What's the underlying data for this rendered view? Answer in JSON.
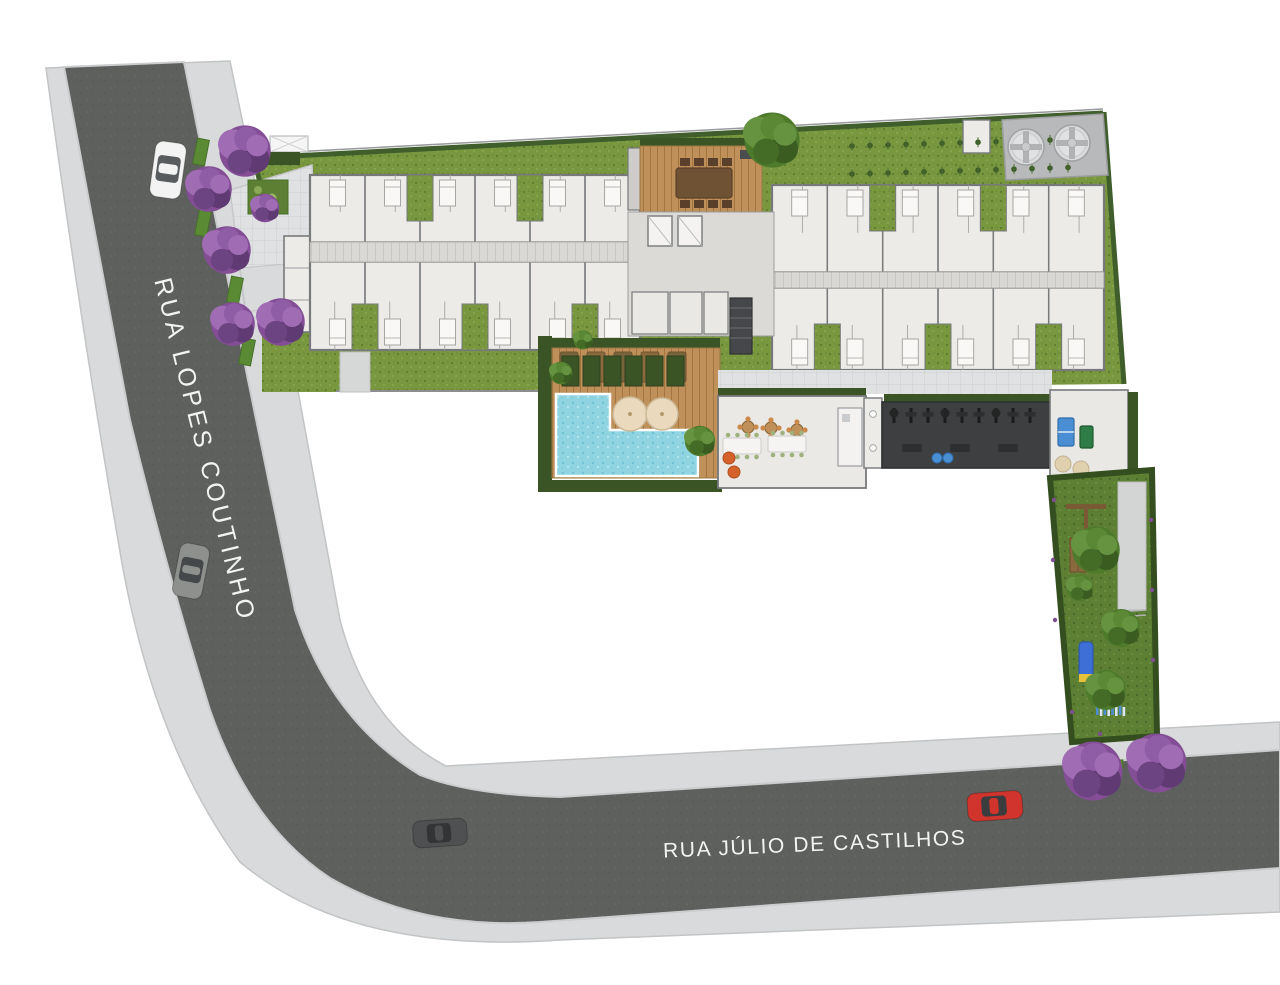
{
  "streets": {
    "diagonal": "RUA LOPES COUTINHO",
    "horizontal": "RUA JÚLIO DE CASTILHOS"
  },
  "palette": {
    "sidewalk": "#d8dadb",
    "curb": "#c9cbcc",
    "asphalt": "#5d605d",
    "wall": "#77797b",
    "wallLight": "#a8a6a3",
    "room": "#ecebe8",
    "bed": "#f9f8f6",
    "corridor": "#dad8d4",
    "grass": "#79973f",
    "grassDark": "#5d7f33",
    "hedge": "#3a5426",
    "hedgeDark": "#2c401f",
    "wood": "#bf9059",
    "woodDark": "#8a6a3c",
    "pool": "#8fd4e0",
    "gymFloor": "#3d3f40",
    "pad": "#b7b9ba",
    "tank": "#d8dadb",
    "umbrella": "#ead9bc",
    "pouf": "#d4622a",
    "blue": "#4a8fd4",
    "purpleTree": [
      "#834e95",
      "#a06cb4",
      "#5f3a73",
      "#8f5da5",
      "#6d4482"
    ],
    "greenTree": [
      "#4e7a2c",
      "#659340",
      "#3a5c20",
      "#5a8835",
      "#456c26"
    ]
  },
  "scene": {
    "cars": [
      {
        "name": "white-car",
        "x": 168,
        "y": 170,
        "w": 31,
        "l": 56,
        "rot": 8,
        "body": "#f2f3f2",
        "cabin": "#585c5f",
        "vertical": true
      },
      {
        "name": "gray-car",
        "x": 191,
        "y": 571,
        "w": 30,
        "l": 54,
        "rot": 11,
        "body": "#8d908d",
        "cabin": "#45484b",
        "vertical": true
      },
      {
        "name": "dark-car",
        "x": 440,
        "y": 833,
        "w": 27,
        "l": 54,
        "rot": -4,
        "body": "#4e5051",
        "cabin": "#323435",
        "vertical": false
      },
      {
        "name": "red-car",
        "x": 995,
        "y": 806,
        "w": 28,
        "l": 55,
        "rot": -4,
        "body": "#d0342c",
        "cabin": "#3a3c3e",
        "vertical": false
      }
    ],
    "purple_trees": [
      [
        245,
        151,
        27
      ],
      [
        209,
        189,
        24
      ],
      [
        227,
        250,
        25
      ],
      [
        233,
        324,
        23
      ],
      [
        281,
        322,
        25
      ],
      [
        265,
        208,
        15
      ],
      [
        1093,
        771,
        31
      ],
      [
        1157,
        763,
        31
      ]
    ],
    "green_trees": [
      [
        772,
        140,
        29
      ],
      [
        1096,
        550,
        25
      ],
      [
        1121,
        628,
        20
      ],
      [
        1106,
        690,
        21
      ],
      [
        700,
        441,
        16
      ],
      [
        561,
        373,
        12
      ],
      [
        583,
        340,
        10
      ],
      [
        1080,
        588,
        14
      ]
    ],
    "verge_strips": [
      [
        201,
        152
      ],
      [
        203,
        223
      ],
      [
        235,
        290
      ],
      [
        247,
        352
      ]
    ],
    "verge_strip_h": [
      1101,
      765
    ],
    "tanks": [
      [
        1026,
        147,
        18
      ],
      [
        1072,
        143,
        18
      ]
    ],
    "wings": [
      {
        "x": 310,
        "y": 175,
        "w": 330,
        "topH": 67,
        "corrH": 20,
        "botH": 88,
        "units": 6
      },
      {
        "x": 772,
        "y": 185,
        "w": 332,
        "topH": 87,
        "corrH": 16,
        "botH": 82,
        "units": 6
      }
    ],
    "loungers": {
      "x0": 560,
      "y": 352,
      "n": 5,
      "dx": 27,
      "w": 18,
      "h": 30
    },
    "umbrellas": [
      [
        630,
        414,
        17
      ],
      [
        662,
        414,
        16
      ]
    ],
    "party": {
      "round_tables": [
        [
          748,
          427
        ],
        [
          771,
          428
        ],
        [
          797,
          430
        ]
      ],
      "long_tables": [
        [
          742,
          446
        ],
        [
          787,
          444
        ]
      ],
      "poufs": [
        [
          729,
          458
        ],
        [
          734,
          472
        ]
      ]
    },
    "gym": {
      "x0": 894,
      "y0": 408,
      "n": 9,
      "dx": 17,
      "benches": 3,
      "balls": [
        [
          937,
          458
        ],
        [
          948,
          458
        ]
      ]
    },
    "garden_plants": {
      "x0": 852,
      "y0": 146,
      "n": 13,
      "dx": 18,
      "dy": 28,
      "slope": -0.03
    },
    "hedge_row": {
      "x0": 562,
      "y": 356,
      "n": 6,
      "dx": 21
    },
    "xylophone": {
      "x0": 1096,
      "y": 706,
      "n": 8,
      "dx": 3.8
    },
    "garden_border_dots": [
      [
        1054,
        500
      ],
      [
        1053,
        560
      ],
      [
        1055,
        620
      ],
      [
        1151,
        520
      ],
      [
        1152,
        590
      ],
      [
        1153,
        660
      ],
      [
        1100,
        734
      ],
      [
        1072,
        712
      ]
    ]
  }
}
